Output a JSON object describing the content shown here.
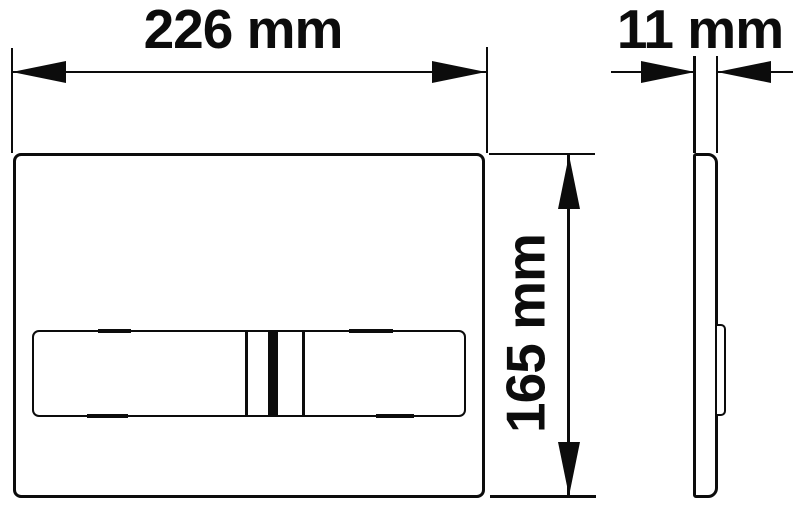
{
  "colors": {
    "line": "#0c0c0c",
    "background": "#ffffff"
  },
  "dimensions": {
    "width": {
      "value": 226,
      "unit": "mm",
      "label": "226 mm"
    },
    "depth": {
      "value": 11,
      "unit": "mm",
      "label": "11 mm"
    },
    "height": {
      "value": 165,
      "unit": "mm",
      "label": "165 mm"
    }
  }
}
